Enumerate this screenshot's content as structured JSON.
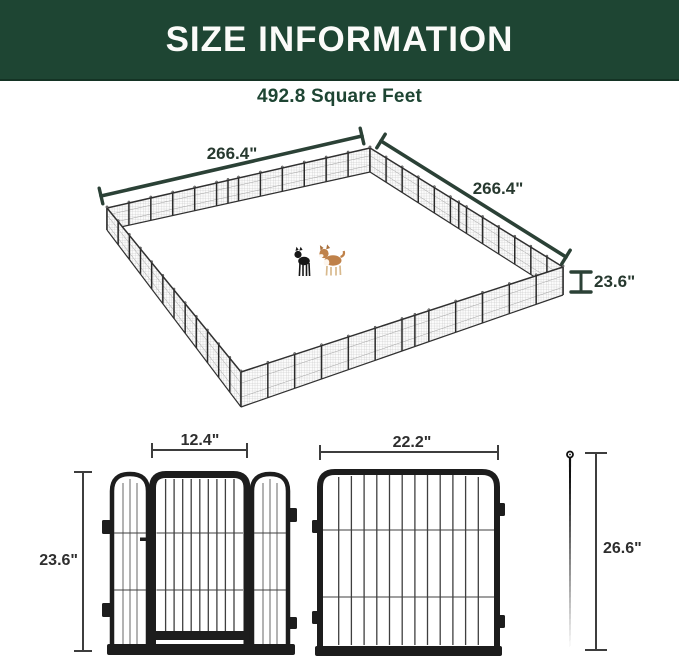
{
  "banner": {
    "title": "SIZE INFORMATION"
  },
  "area_label": "492.8 Square Feet",
  "pen_diagram": {
    "left_side_length": "266.4\"",
    "right_side_length": "266.4\"",
    "panel_height": "23.6\""
  },
  "gate_diagram": {
    "width_label": "12.4\"",
    "height_label": "23.6\""
  },
  "panel_diagram": {
    "width_label": "22.2\""
  },
  "stake_diagram": {
    "height_label": "26.6\""
  },
  "colors": {
    "banner_green": "#1e4533",
    "dimension_green": "#2b4136",
    "figure_line_dark": "#3d3d3d",
    "frame_black": "#1d1d1d",
    "corgi_tan": "#bf8149",
    "dog_black": "#161616"
  }
}
